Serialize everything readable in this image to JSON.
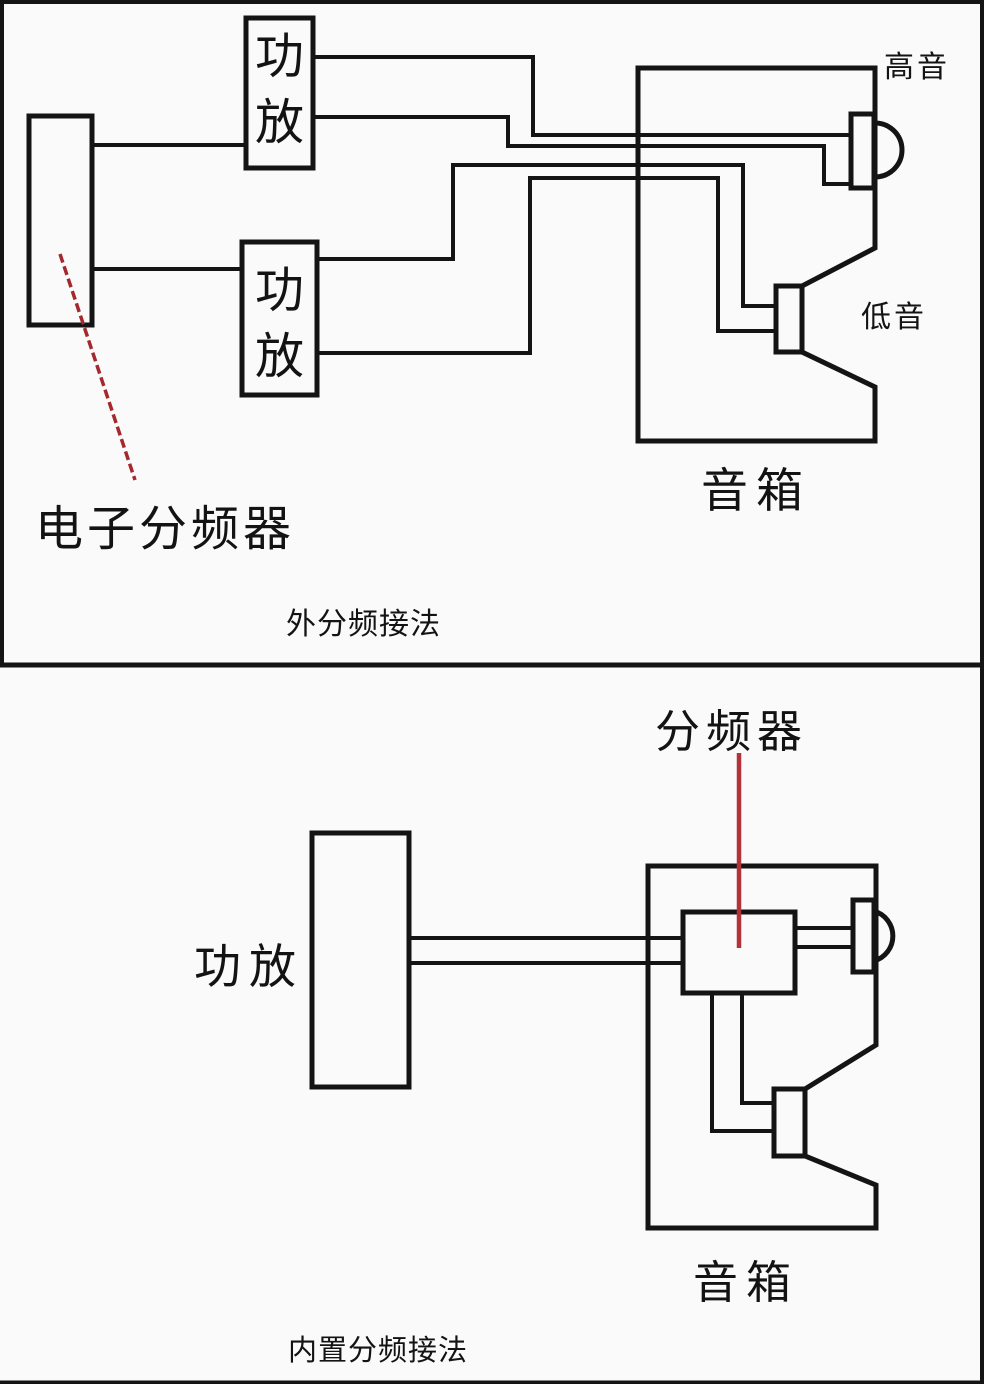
{
  "page": {
    "background_color": "#fafafa",
    "line_color": "#141414",
    "annotation_red_dashed": "#a5282d",
    "annotation_red_solid": "#b13338"
  },
  "top_diagram": {
    "crossover_label": "电子分频器",
    "amplifier_top_label": "功放",
    "amplifier_bottom_label": "功放",
    "speaker_label": "音箱",
    "tweeter_label": "高音",
    "woofer_label": "低音",
    "caption": "外分频接法"
  },
  "bottom_diagram": {
    "crossover_label": "分频器",
    "amplifier_label": "功放",
    "speaker_label": "音箱",
    "caption": "内置分频接法"
  }
}
